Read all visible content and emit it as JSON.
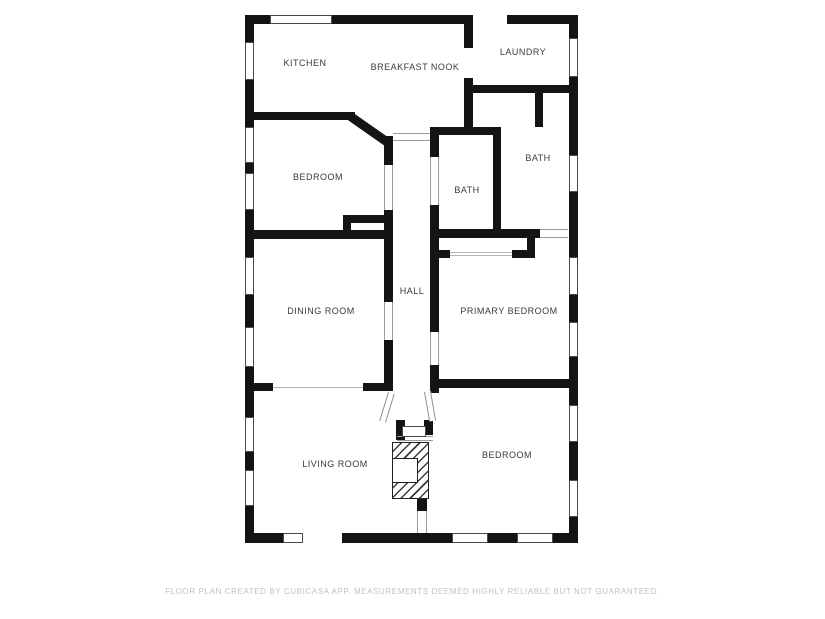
{
  "footer": {
    "text": "FLOOR PLAN CREATED BY CUBICASA APP. MEASUREMENTS DEEMED HIGHLY RELIABLE BUT NOT GUARANTEED."
  },
  "plan": {
    "colors": {
      "wall": "#141414",
      "window_border": "#4a4a4a",
      "opening_line": "#9c9c9c",
      "label": "#3a3a3a",
      "hatch": "#3a3a3a"
    },
    "rooms": [
      {
        "id": "kitchen",
        "label": "KITCHEN",
        "x": 305,
        "y": 63
      },
      {
        "id": "breakfast-nook",
        "label": "BREAKFAST NOOK",
        "x": 415,
        "y": 67
      },
      {
        "id": "laundry",
        "label": "LAUNDRY",
        "x": 523,
        "y": 52
      },
      {
        "id": "bedroom-upper",
        "label": "BEDROOM",
        "x": 318,
        "y": 177
      },
      {
        "id": "bath-left",
        "label": "BATH",
        "x": 467,
        "y": 190
      },
      {
        "id": "bath-right",
        "label": "BATH",
        "x": 538,
        "y": 158
      },
      {
        "id": "dining-room",
        "label": "DINING ROOM",
        "x": 321,
        "y": 311
      },
      {
        "id": "hall",
        "label": "HALL",
        "x": 412,
        "y": 291
      },
      {
        "id": "primary-bedroom",
        "label": "PRIMARY BEDROOM",
        "x": 509,
        "y": 311
      },
      {
        "id": "living-room",
        "label": "LIVING ROOM",
        "x": 335,
        "y": 464
      },
      {
        "id": "bedroom-lower",
        "label": "BEDROOM",
        "x": 507,
        "y": 455
      }
    ],
    "walls": [
      [
        245,
        15,
        25,
        9
      ],
      [
        298,
        15,
        4,
        9
      ],
      [
        332,
        15,
        141,
        9
      ],
      [
        507,
        15,
        71,
        9
      ],
      [
        245,
        533,
        38,
        10
      ],
      [
        342,
        533,
        110,
        10
      ],
      [
        488,
        533,
        29,
        10
      ],
      [
        553,
        533,
        25,
        10
      ],
      [
        245,
        15,
        9,
        27
      ],
      [
        245,
        80,
        9,
        47
      ],
      [
        245,
        163,
        9,
        10
      ],
      [
        245,
        210,
        9,
        47
      ],
      [
        245,
        295,
        9,
        32
      ],
      [
        245,
        367,
        9,
        50
      ],
      [
        245,
        452,
        9,
        18
      ],
      [
        245,
        506,
        9,
        37
      ],
      [
        569,
        15,
        9,
        23
      ],
      [
        569,
        77,
        9,
        78
      ],
      [
        569,
        192,
        9,
        65
      ],
      [
        569,
        295,
        9,
        27
      ],
      [
        569,
        357,
        9,
        48
      ],
      [
        569,
        442,
        9,
        38
      ],
      [
        569,
        517,
        9,
        26
      ],
      [
        245,
        112,
        110,
        8
      ],
      [
        245,
        230,
        148,
        9
      ],
      [
        351,
        215,
        33,
        8
      ],
      [
        343,
        215,
        8,
        23
      ],
      [
        384,
        136,
        9,
        29
      ],
      [
        384,
        210,
        9,
        92
      ],
      [
        384,
        340,
        9,
        50
      ],
      [
        430,
        127,
        9,
        30
      ],
      [
        430,
        205,
        9,
        127
      ],
      [
        430,
        365,
        9,
        28
      ],
      [
        464,
        24,
        9,
        24
      ],
      [
        464,
        78,
        9,
        50
      ],
      [
        464,
        85,
        114,
        8
      ],
      [
        535,
        93,
        8,
        34
      ],
      [
        430,
        127,
        71,
        8
      ],
      [
        493,
        127,
        8,
        103
      ],
      [
        430,
        229,
        110,
        9
      ],
      [
        527,
        238,
        8,
        20
      ],
      [
        438,
        250,
        12,
        8
      ],
      [
        512,
        250,
        23,
        8
      ],
      [
        245,
        383,
        28,
        8
      ],
      [
        363,
        383,
        30,
        8
      ],
      [
        436,
        379,
        142,
        9
      ],
      [
        396,
        420,
        9,
        20
      ],
      [
        424,
        420,
        9,
        15
      ],
      [
        417,
        493,
        10,
        18
      ]
    ],
    "windows": [
      [
        270,
        15,
        62,
        9
      ],
      [
        283,
        533,
        20,
        10
      ],
      [
        452,
        533,
        36,
        10
      ],
      [
        517,
        533,
        36,
        10
      ],
      [
        245,
        42,
        9,
        38
      ],
      [
        245,
        127,
        9,
        36
      ],
      [
        245,
        173,
        9,
        37
      ],
      [
        245,
        257,
        9,
        38
      ],
      [
        245,
        327,
        9,
        40
      ],
      [
        245,
        417,
        9,
        35
      ],
      [
        245,
        470,
        9,
        36
      ],
      [
        569,
        38,
        9,
        39
      ],
      [
        569,
        155,
        9,
        37
      ],
      [
        569,
        257,
        9,
        38
      ],
      [
        569,
        322,
        9,
        35
      ],
      [
        569,
        405,
        9,
        37
      ],
      [
        569,
        480,
        9,
        37
      ]
    ],
    "plain_gaps": [
      [
        473,
        15,
        34,
        9
      ],
      [
        303,
        533,
        39,
        10
      ],
      [
        464,
        48,
        9,
        30
      ]
    ],
    "door_gaps": [
      {
        "x": 384,
        "y": 165,
        "w": 9,
        "h": 45,
        "o": "v"
      },
      {
        "x": 384,
        "y": 302,
        "w": 9,
        "h": 38,
        "o": "v"
      },
      {
        "x": 430,
        "y": 157,
        "w": 9,
        "h": 48,
        "o": "v"
      },
      {
        "x": 430,
        "y": 332,
        "w": 9,
        "h": 33,
        "o": "v"
      },
      {
        "x": 540,
        "y": 229,
        "w": 28,
        "h": 9,
        "o": "h"
      },
      {
        "x": 417,
        "y": 511,
        "w": 10,
        "h": 22,
        "o": "v"
      }
    ],
    "passages": [
      {
        "x": 393,
        "y": 133,
        "w": 37,
        "h": 8
      },
      {
        "x": 397,
        "y": 436,
        "w": 36,
        "h": 5
      }
    ],
    "lines": [
      [
        273,
        387,
        90,
        1
      ],
      [
        450,
        252,
        62,
        1
      ],
      [
        450,
        255,
        62,
        1
      ]
    ],
    "diagonals": [
      {
        "x": 352,
        "y": 112,
        "len": 49,
        "th": 9,
        "deg": 35
      }
    ],
    "splays": [
      {
        "x": 388,
        "y": 392,
        "w": 7,
        "h": 30,
        "deg": 17
      },
      {
        "x": 424,
        "y": 392,
        "w": 7,
        "h": 30,
        "deg": -10
      }
    ],
    "front_door": {
      "x": 402,
      "y": 426,
      "w": 24,
      "h": 11
    },
    "fireplace": {
      "x": 392,
      "y": 442,
      "w": 37,
      "h": 57,
      "notch": {
        "x": 392,
        "y": 458,
        "w": 26,
        "h": 25
      }
    }
  }
}
